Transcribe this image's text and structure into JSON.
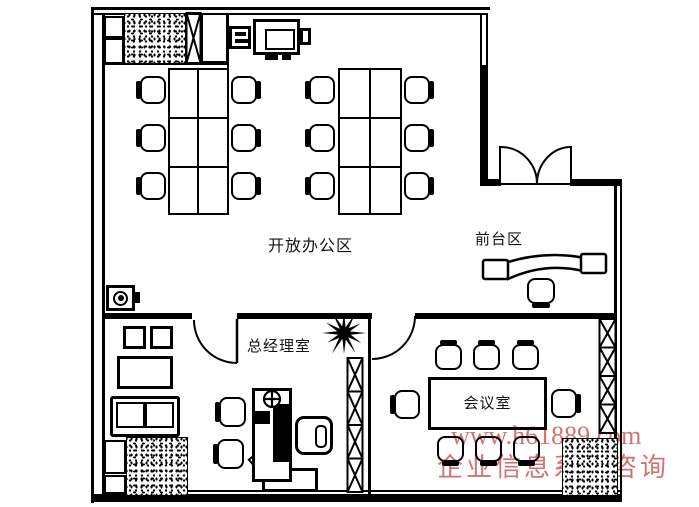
{
  "rooms": {
    "open_office": {
      "label": "开放办公区"
    },
    "reception": {
      "label": "前台区"
    },
    "gm_office": {
      "label": "总经理室"
    },
    "meeting": {
      "label": "会议室"
    }
  },
  "watermark": {
    "line1": "www.h61889.com",
    "line2": "企业信息系统咨询",
    "color": "#c95a5a"
  },
  "palette": {
    "line": "#000000",
    "background": "#ffffff"
  }
}
